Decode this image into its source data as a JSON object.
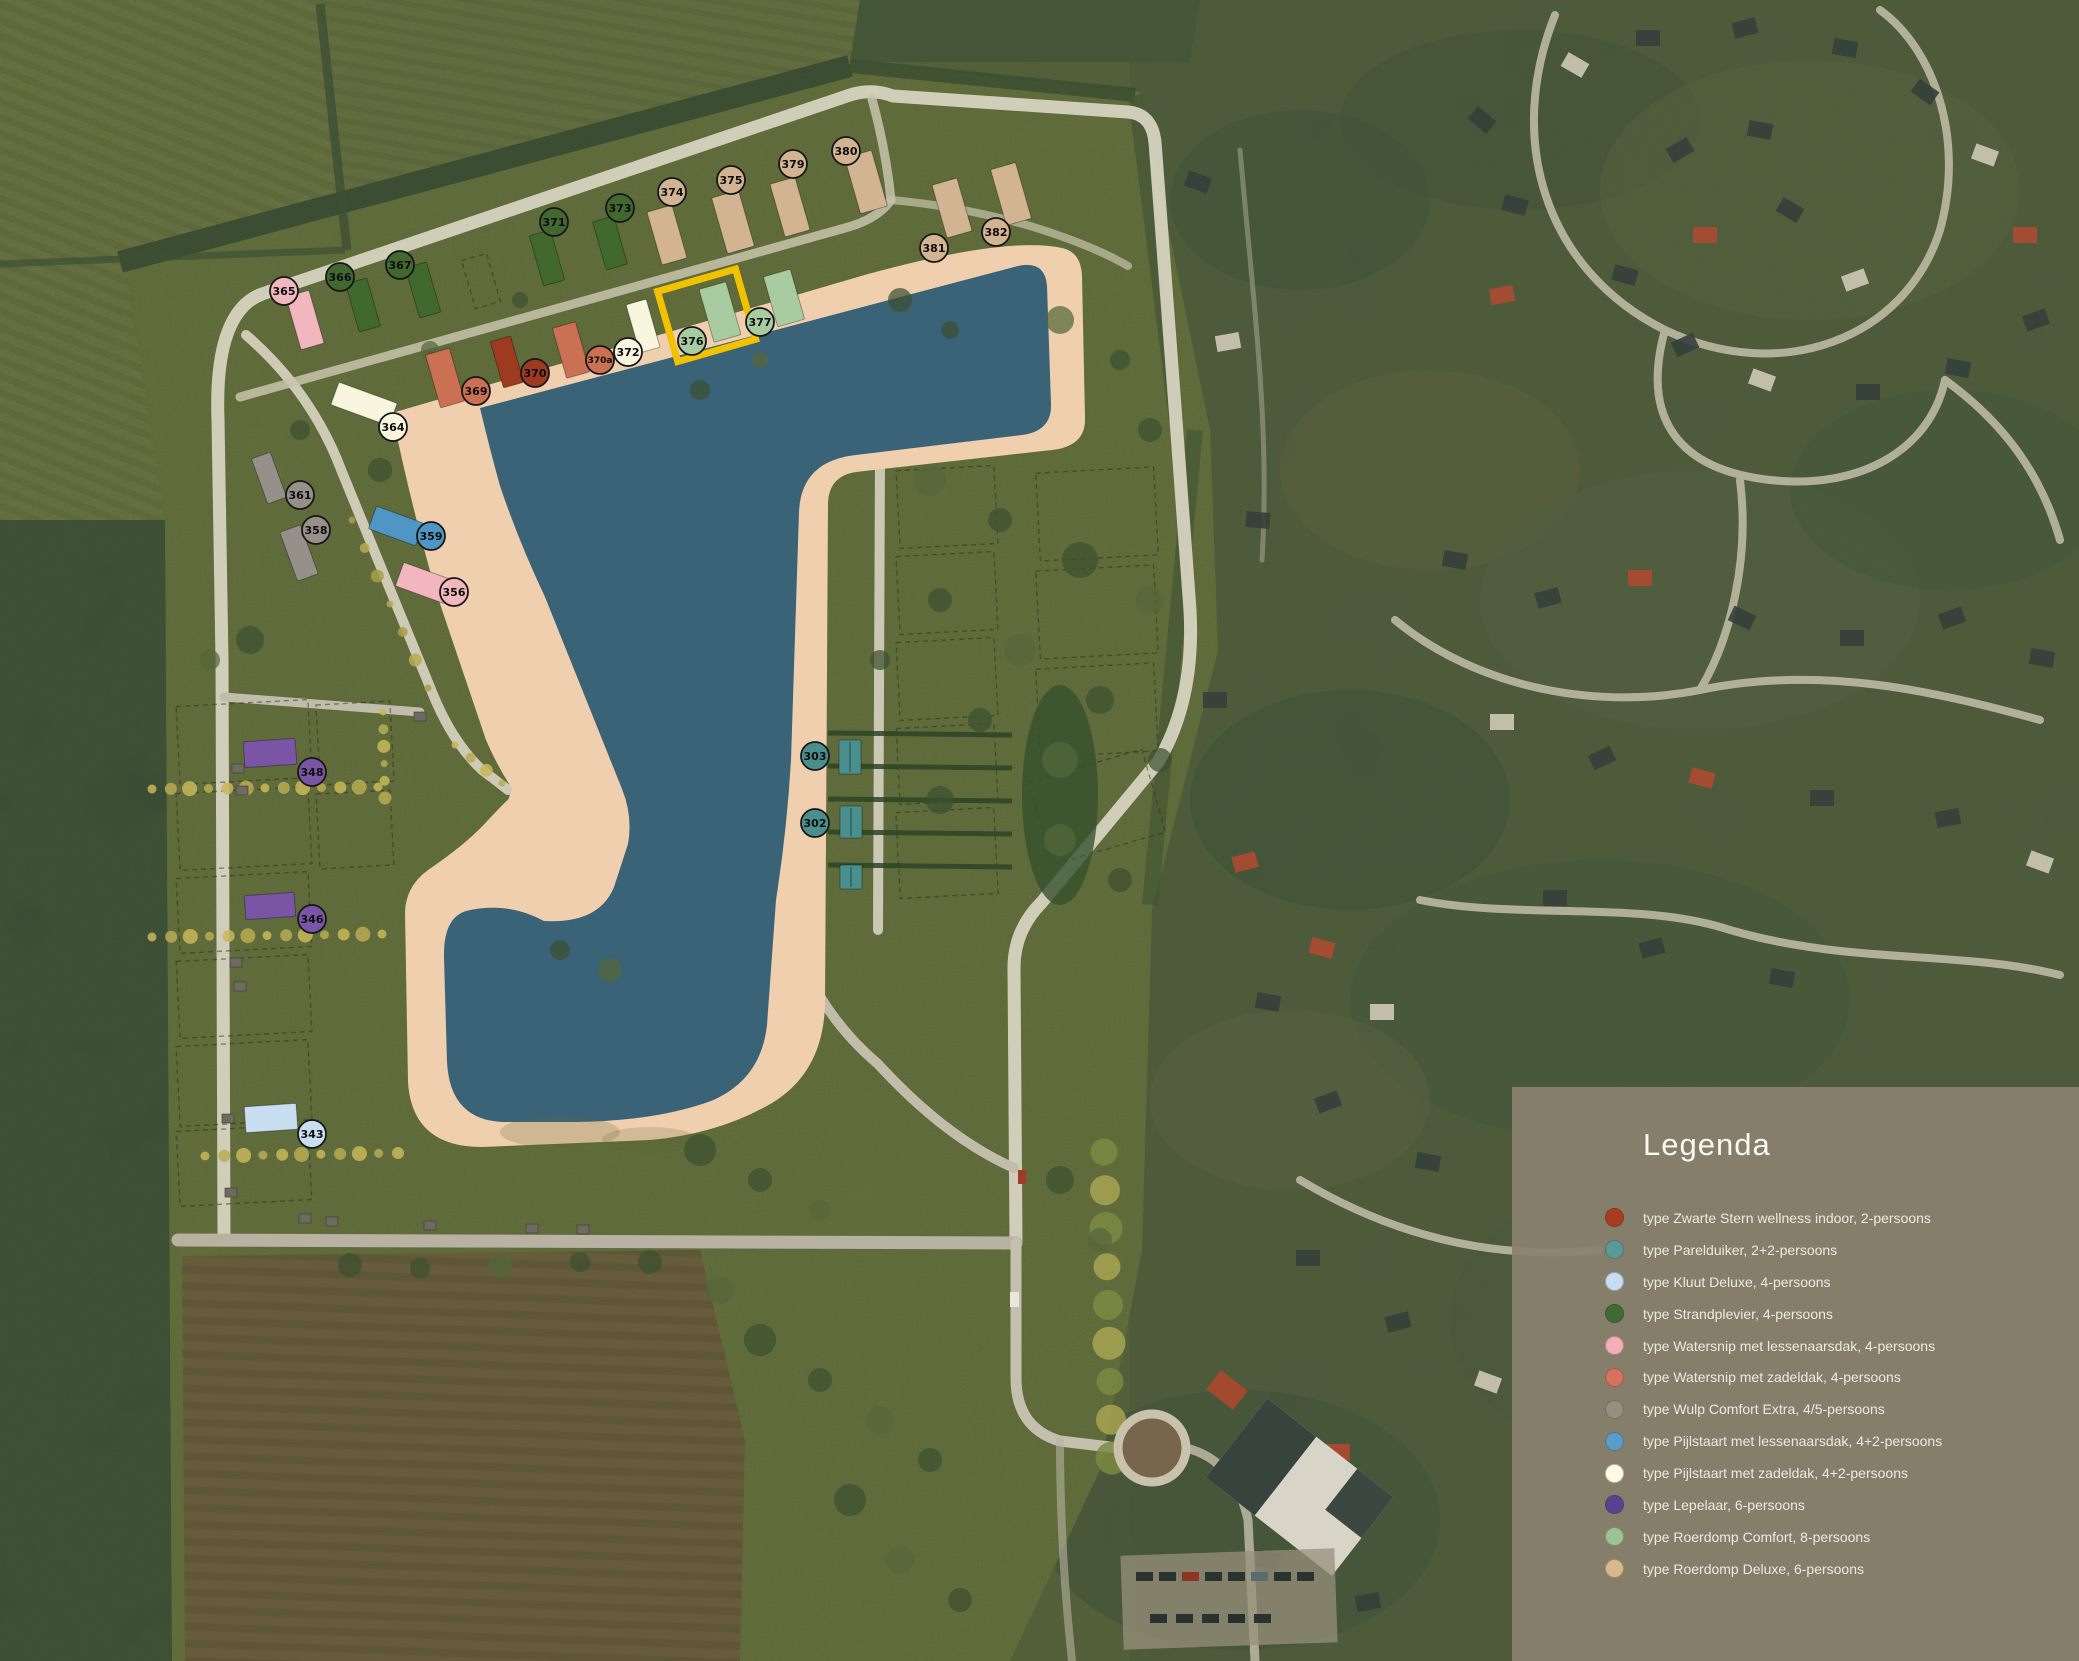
{
  "legend": {
    "title": "Legenda",
    "entries": [
      {
        "label": "type Zwarte Stern wellness indoor, 2-persoons",
        "color": "#A93B20"
      },
      {
        "label": "type Parelduiker, 2+2-persoons",
        "color": "#5A9A96"
      },
      {
        "label": "type Kluut Deluxe, 4-persoons",
        "color": "#C7DDF1"
      },
      {
        "label": "type Strandplevier, 4-persoons",
        "color": "#3F6B35"
      },
      {
        "label": "type Watersnip met lessenaarsdak, 4-persoons",
        "color": "#F3AEBB"
      },
      {
        "label": "type Watersnip met zadeldak, 4-persoons",
        "color": "#D5735B"
      },
      {
        "label": "type Wulp Comfort Extra, 4/5-persoons",
        "color": "#968E81"
      },
      {
        "label": "type Pijlstaart met lessenaarsdak, 4+2-persoons",
        "color": "#5B9DC6"
      },
      {
        "label": "type Pijlstaart met zadeldak, 4+2-persoons",
        "color": "#FDFCE3"
      },
      {
        "label": "type Lepelaar, 6-persoons",
        "color": "#5D4191"
      },
      {
        "label": "type Roerdomp Comfort, 8-persoons",
        "color": "#9CC394"
      },
      {
        "label": "type Roerdomp Deluxe, 6-persoons",
        "color": "#D9B88B"
      }
    ]
  },
  "map": {
    "highlighted_lot": "376",
    "highlight_color": "#F2C200",
    "water_color": "#3A6378",
    "sand_color": "#F0CFAF",
    "type_colors": {
      "zs": "#9E3A1F",
      "pa": "#4A8F8E",
      "kl": "#C9DEF0",
      "sp": "#40682F",
      "wl": "#F2B6BF",
      "wz": "#CC7053",
      "wu": "#97908A",
      "pl": "#4F96C4",
      "pz": "#F8F6DF",
      "le": "#7A55A6",
      "rc": "#A9CBA1",
      "rd": "#D2B392"
    },
    "markers": [
      {
        "id": "365",
        "x": 284,
        "y": 291,
        "t": "wl"
      },
      {
        "id": "366",
        "x": 340,
        "y": 277,
        "t": "sp"
      },
      {
        "id": "367",
        "x": 400,
        "y": 265,
        "t": "sp"
      },
      {
        "id": "371",
        "x": 554,
        "y": 222,
        "t": "sp"
      },
      {
        "id": "373",
        "x": 620,
        "y": 208,
        "t": "sp"
      },
      {
        "id": "374",
        "x": 672,
        "y": 192,
        "t": "rd"
      },
      {
        "id": "375",
        "x": 731,
        "y": 180,
        "t": "rd"
      },
      {
        "id": "379",
        "x": 793,
        "y": 164,
        "t": "rd"
      },
      {
        "id": "380",
        "x": 846,
        "y": 151,
        "t": "rd"
      },
      {
        "id": "381",
        "x": 934,
        "y": 248,
        "t": "rd"
      },
      {
        "id": "382",
        "x": 996,
        "y": 232,
        "t": "rd"
      },
      {
        "id": "364",
        "x": 393,
        "y": 427,
        "t": "pz"
      },
      {
        "id": "369",
        "x": 476,
        "y": 391,
        "t": "wz"
      },
      {
        "id": "370",
        "x": 535,
        "y": 373,
        "t": "zs"
      },
      {
        "id": "370a",
        "x": 600,
        "y": 360,
        "t": "wz"
      },
      {
        "id": "372",
        "x": 628,
        "y": 352,
        "t": "pz"
      },
      {
        "id": "376",
        "x": 692,
        "y": 341,
        "t": "rc"
      },
      {
        "id": "377",
        "x": 760,
        "y": 322,
        "t": "rc"
      },
      {
        "id": "361",
        "x": 300,
        "y": 495,
        "t": "wu"
      },
      {
        "id": "358",
        "x": 316,
        "y": 530,
        "t": "wu"
      },
      {
        "id": "359",
        "x": 431,
        "y": 536,
        "t": "pl"
      },
      {
        "id": "356",
        "x": 454,
        "y": 592,
        "t": "wl"
      },
      {
        "id": "348",
        "x": 312,
        "y": 772,
        "t": "le"
      },
      {
        "id": "346",
        "x": 312,
        "y": 919,
        "t": "le"
      },
      {
        "id": "343",
        "x": 312,
        "y": 1134,
        "t": "kl"
      },
      {
        "id": "303",
        "x": 815,
        "y": 756,
        "t": "pa"
      },
      {
        "id": "302",
        "x": 815,
        "y": 823,
        "t": "pa"
      }
    ],
    "houses": [
      {
        "x": 305,
        "y": 320,
        "w": 24,
        "h": 55,
        "r": -16,
        "t": "wl"
      },
      {
        "x": 363,
        "y": 305,
        "w": 22,
        "h": 50,
        "r": -16,
        "t": "sp"
      },
      {
        "x": 423,
        "y": 290,
        "w": 22,
        "h": 52,
        "r": -16,
        "t": "sp"
      },
      {
        "x": 547,
        "y": 258,
        "w": 22,
        "h": 52,
        "r": -16,
        "t": "sp"
      },
      {
        "x": 610,
        "y": 243,
        "w": 22,
        "h": 50,
        "r": -16,
        "t": "sp"
      },
      {
        "x": 667,
        "y": 235,
        "w": 26,
        "h": 55,
        "r": -16,
        "t": "rd"
      },
      {
        "x": 733,
        "y": 222,
        "w": 28,
        "h": 58,
        "r": -16,
        "t": "rd"
      },
      {
        "x": 790,
        "y": 207,
        "w": 26,
        "h": 55,
        "r": -16,
        "t": "rd"
      },
      {
        "x": 866,
        "y": 182,
        "w": 28,
        "h": 58,
        "r": -16,
        "t": "rd"
      },
      {
        "x": 952,
        "y": 208,
        "w": 26,
        "h": 55,
        "r": -16,
        "t": "rd"
      },
      {
        "x": 1011,
        "y": 194,
        "w": 26,
        "h": 58,
        "r": -16,
        "t": "rd"
      },
      {
        "x": 364,
        "y": 404,
        "w": 24,
        "h": 62,
        "r": -70,
        "t": "pz"
      },
      {
        "x": 445,
        "y": 378,
        "w": 25,
        "h": 55,
        "r": -16,
        "t": "wz"
      },
      {
        "x": 507,
        "y": 362,
        "w": 21,
        "h": 48,
        "r": -16,
        "t": "zs"
      },
      {
        "x": 571,
        "y": 350,
        "w": 24,
        "h": 52,
        "r": -16,
        "t": "wz"
      },
      {
        "x": 643,
        "y": 326,
        "w": 21,
        "h": 50,
        "r": -16,
        "t": "pz"
      },
      {
        "x": 720,
        "y": 312,
        "w": 28,
        "h": 55,
        "r": -16,
        "t": "rc"
      },
      {
        "x": 784,
        "y": 298,
        "w": 28,
        "h": 52,
        "r": -16,
        "t": "rc"
      },
      {
        "x": 269,
        "y": 478,
        "w": 20,
        "h": 48,
        "r": -20,
        "t": "wu"
      },
      {
        "x": 299,
        "y": 553,
        "w": 22,
        "h": 52,
        "r": -20,
        "t": "wu"
      },
      {
        "x": 396,
        "y": 526,
        "w": 24,
        "h": 50,
        "r": -70,
        "t": "pl"
      },
      {
        "x": 424,
        "y": 583,
        "w": 25,
        "h": 52,
        "r": -70,
        "t": "wl"
      },
      {
        "x": 270,
        "y": 753,
        "w": 52,
        "h": 26,
        "r": -4,
        "t": "le"
      },
      {
        "x": 270,
        "y": 906,
        "w": 50,
        "h": 24,
        "r": -4,
        "t": "le"
      },
      {
        "x": 271,
        "y": 1118,
        "w": 52,
        "h": 26,
        "r": -4,
        "t": "kl"
      },
      {
        "x": 850,
        "y": 757,
        "w": 22,
        "h": 34,
        "r": 0,
        "t": "pa"
      },
      {
        "x": 851,
        "y": 822,
        "w": 22,
        "h": 32,
        "r": 0,
        "t": "pa"
      },
      {
        "x": 851,
        "y": 877,
        "w": 22,
        "h": 24,
        "r": 0,
        "t": "pa"
      }
    ]
  }
}
